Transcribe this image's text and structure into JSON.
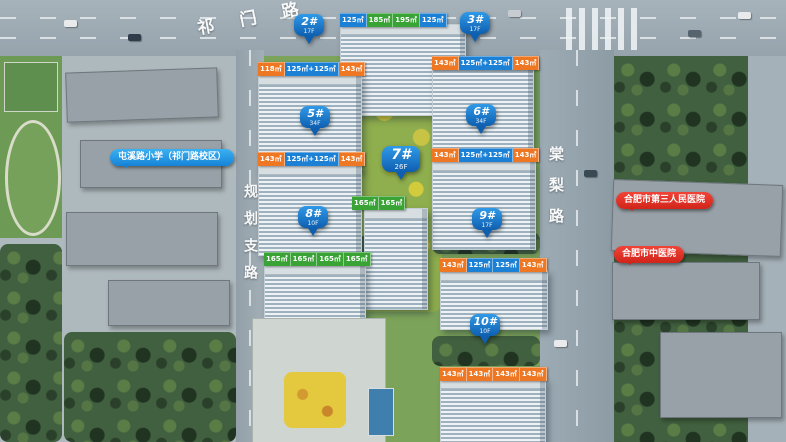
{
  "roads": {
    "top": "祁门路",
    "left": "规划支路",
    "right": "棠梨路"
  },
  "pois": {
    "school": {
      "label": "屯溪路小学（祁门路校区）"
    },
    "hospital_1": {
      "label": "合肥市第三人民医院"
    },
    "hospital_2": {
      "label": "合肥市中医院"
    }
  },
  "buildings": {
    "b1": {
      "units": [
        "125㎡",
        "185㎡",
        "195㎡",
        "125㎡"
      ]
    },
    "b2": {
      "no": "2#",
      "floors": "17F",
      "units": [
        "118㎡",
        "125㎡+125㎡",
        "143㎡"
      ]
    },
    "b3": {
      "no": "3#",
      "floors": "17F",
      "units": [
        "143㎡",
        "125㎡+125㎡",
        "143㎡"
      ]
    },
    "b5": {
      "no": "5#",
      "floors": "34F",
      "units": [
        "143㎡",
        "125㎡+125㎡",
        "143㎡"
      ]
    },
    "b6": {
      "no": "6#",
      "floors": "34F",
      "units": [
        "143㎡",
        "125㎡+125㎡",
        "143㎡"
      ]
    },
    "b7": {
      "no": "7#",
      "floors": "26F",
      "units": [
        "165㎡",
        "165㎡"
      ]
    },
    "b8": {
      "no": "8#",
      "floors": "10F",
      "units": [
        "165㎡",
        "165㎡",
        "165㎡",
        "165㎡"
      ]
    },
    "b9": {
      "no": "9#",
      "floors": "17F",
      "units": [
        "143㎡",
        "125㎡",
        "125㎡",
        "143㎡"
      ]
    },
    "b10": {
      "no": "10#",
      "floors": "10F",
      "units": [
        "143㎡",
        "143㎡",
        "143㎡",
        "143㎡"
      ]
    }
  },
  "colors": {
    "pin_blue": "#1374cf",
    "tag_orange": "#ee7723",
    "tag_blue": "#1c80d4",
    "tag_green": "#3aa335",
    "poi_blue": "#2399e4",
    "poi_red": "#e2281e"
  }
}
